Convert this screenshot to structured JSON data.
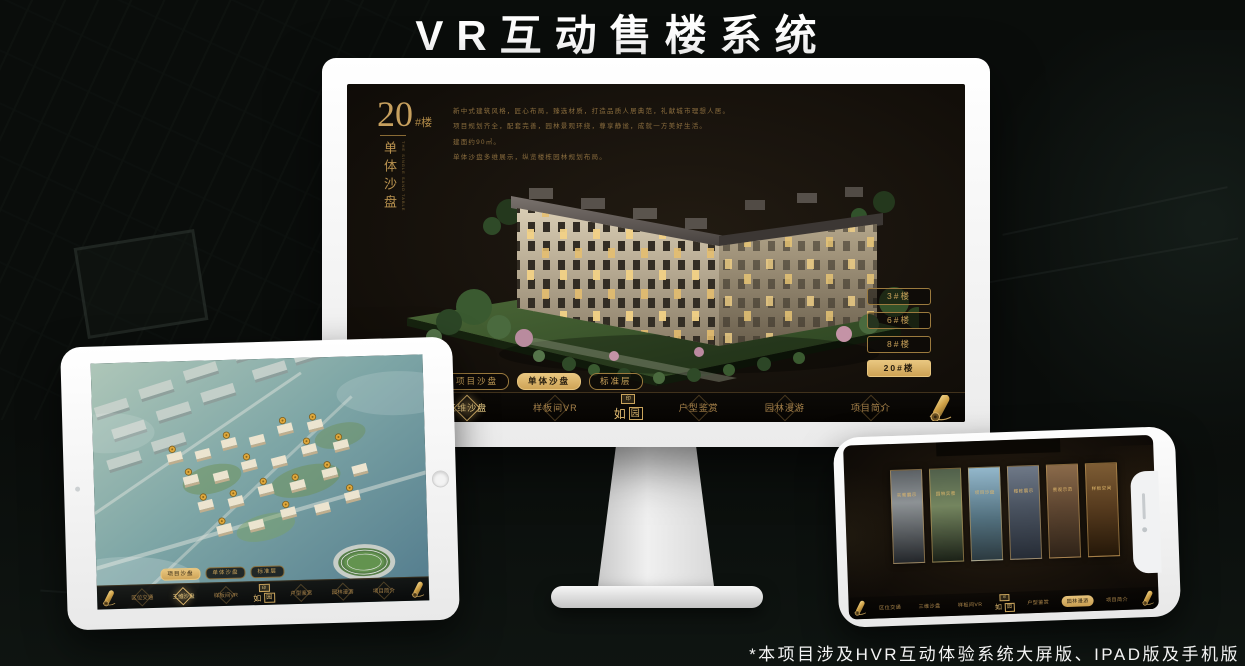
{
  "page": {
    "title": "VR互动售楼系统",
    "footnote": "*本项目涉及HVR互动体验系统大屏版、IPAD版及手机版"
  },
  "colors": {
    "gold": "#c9a25a",
    "gold_bright": "#e8c67f",
    "screen_bg": "#17120c",
    "device_white": "#f5f5f5"
  },
  "logo": {
    "name": "如园",
    "main": "如",
    "seal_char": "园",
    "seal_mark": "印"
  },
  "monitor": {
    "floor_no": "20",
    "floor_suffix": "#楼",
    "floor_title": "单体沙盘",
    "floor_title_en": "THE SINGLE SAND TABLE",
    "desc_lines": [
      "新中式建筑风格，匠心布局，臻选材质，打造品质人居典范，礼献城市理想人居。",
      "项目规划齐全，配套完善，园林景观环绕，尊享静谧，成就一方美好生活。",
      "建面约90㎡。",
      "单体沙盘多维展示，纵览楼栋园林规划布局。"
    ],
    "floor_buttons": [
      {
        "label": "3#楼",
        "selected": false
      },
      {
        "label": "6#楼",
        "selected": false
      },
      {
        "label": "8#楼",
        "selected": false
      },
      {
        "label": "20#楼",
        "selected": true
      }
    ],
    "tabs": [
      {
        "label": "项目沙盘",
        "selected": false
      },
      {
        "label": "单体沙盘",
        "selected": true
      },
      {
        "label": "标准层",
        "selected": false
      }
    ],
    "nav": [
      {
        "label": "区位交通",
        "selected": false
      },
      {
        "label": "三维沙盘",
        "selected": true
      },
      {
        "label": "样板间VR",
        "selected": false
      },
      {
        "label": "户型鉴赏",
        "selected": false
      },
      {
        "label": "园林漫游",
        "selected": false
      },
      {
        "label": "项目简介",
        "selected": false
      }
    ]
  },
  "tablet": {
    "tabs": [
      {
        "label": "项目沙盘",
        "selected": true
      },
      {
        "label": "单体沙盘",
        "selected": false
      },
      {
        "label": "标准层",
        "selected": false
      }
    ],
    "nav": [
      {
        "label": "区位交通",
        "selected": false
      },
      {
        "label": "三维沙盘",
        "selected": true
      },
      {
        "label": "样板间VR",
        "selected": false
      },
      {
        "label": "户型鉴赏",
        "selected": false
      },
      {
        "label": "园林漫游",
        "selected": false
      },
      {
        "label": "项目简介",
        "selected": false
      }
    ]
  },
  "phone": {
    "panels": [
      {
        "label": "实景展示"
      },
      {
        "label": "园林实景"
      },
      {
        "label": "项目沙盘"
      },
      {
        "label": "楼栋展示"
      },
      {
        "label": "景观示范"
      },
      {
        "label": "样板空间"
      }
    ],
    "nav": [
      {
        "label": "区位交通",
        "selected": false
      },
      {
        "label": "三维沙盘",
        "selected": false
      },
      {
        "label": "样板间VR",
        "selected": false
      },
      {
        "label": "户型鉴赏",
        "selected": false
      },
      {
        "label": "园林漫游",
        "selected": true
      },
      {
        "label": "项目简介",
        "selected": false
      }
    ]
  }
}
